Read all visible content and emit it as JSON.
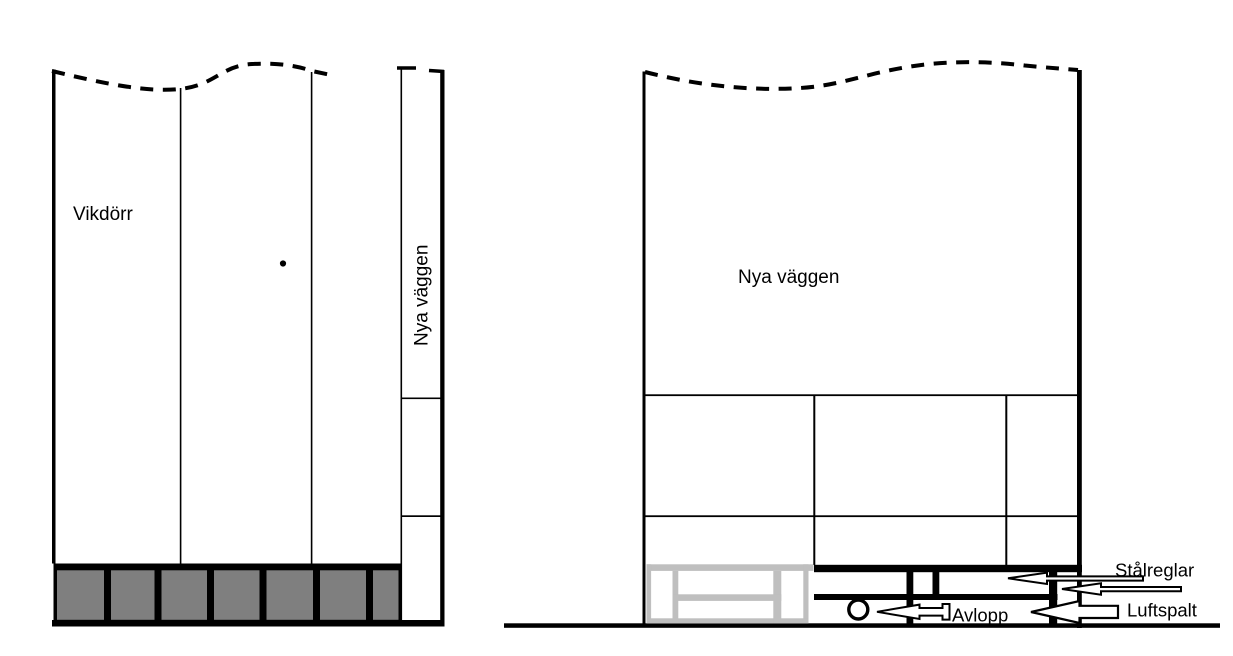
{
  "diagram": {
    "left_elevation": {
      "door_label": "Vikdörr",
      "wall_label_rotated": "Nya väggen"
    },
    "right_elevation": {
      "wall_label": "Nya väggen"
    },
    "annotations": {
      "steel_studs_label": "Stålreglar",
      "air_gap_label": "Luftspalt",
      "drain_label": "Avlopp"
    },
    "colors": {
      "line_black": "#000000",
      "door_sill_gray": "#7f7f7f",
      "bench_gray": "#bfbfbf",
      "background": "#ffffff"
    }
  }
}
